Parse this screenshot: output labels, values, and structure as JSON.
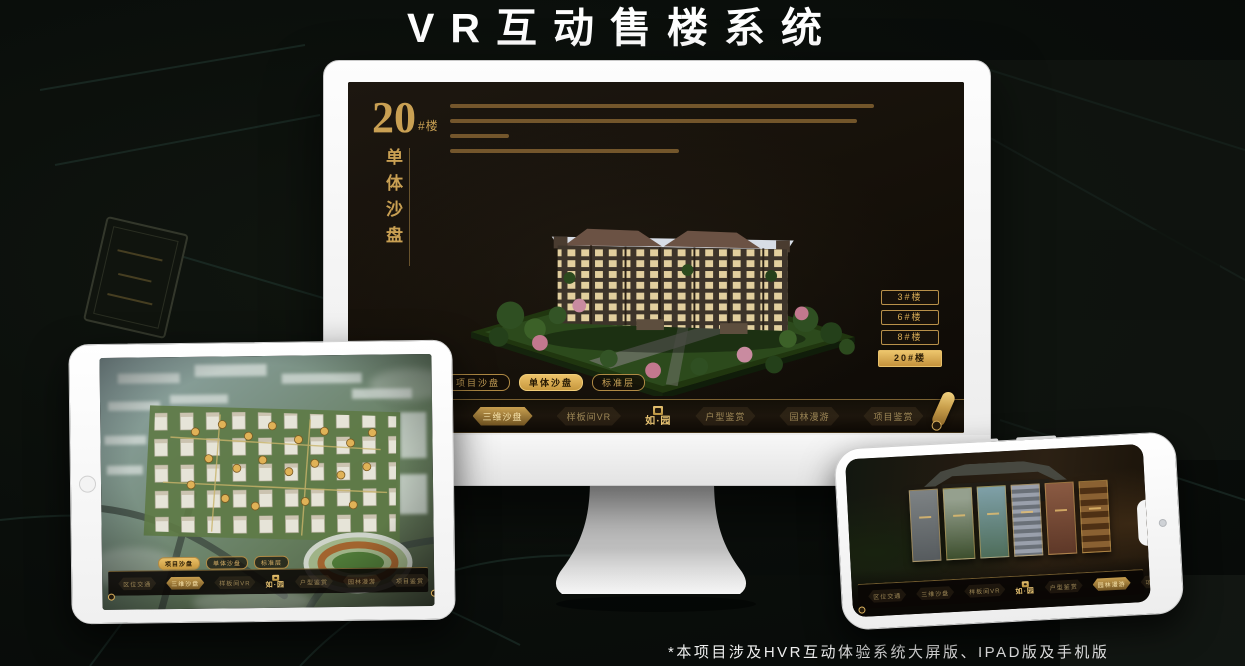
{
  "header": {
    "title": "VR互动售楼系统"
  },
  "footer": {
    "note": "*本项目涉及HVR互动体验系统大屏版、IPAD版及手机版"
  },
  "colors": {
    "accent_gold": "#D8AC56",
    "app_background": "#17110A",
    "device_shell": "#F5F5F5"
  },
  "app": {
    "logo": "如·园",
    "nav_items": [
      {
        "label": "区位交通"
      },
      {
        "label": "三维沙盘"
      },
      {
        "label": "样板间VR"
      },
      {
        "label": "户型鉴赏"
      },
      {
        "label": "园林漫游"
      },
      {
        "label": "项目鉴赏"
      }
    ],
    "subtabs": [
      {
        "label": "项目沙盘"
      },
      {
        "label": "单体沙盘"
      },
      {
        "label": "标准层"
      }
    ]
  },
  "monitor_screen": {
    "hero_number": "20",
    "hero_suffix": "#楼",
    "hero_title": "单体沙盘",
    "building_buttons": [
      {
        "label": "3#楼"
      },
      {
        "label": "6#楼"
      },
      {
        "label": "8#楼"
      },
      {
        "label": "20#楼",
        "active": true
      }
    ],
    "active_subtab": "单体沙盘",
    "active_nav": "三维沙盘"
  },
  "tablet_screen": {
    "active_subtab": "项目沙盘",
    "active_nav": "三维沙盘"
  },
  "phone_screen": {
    "active_nav": "园林漫游"
  }
}
